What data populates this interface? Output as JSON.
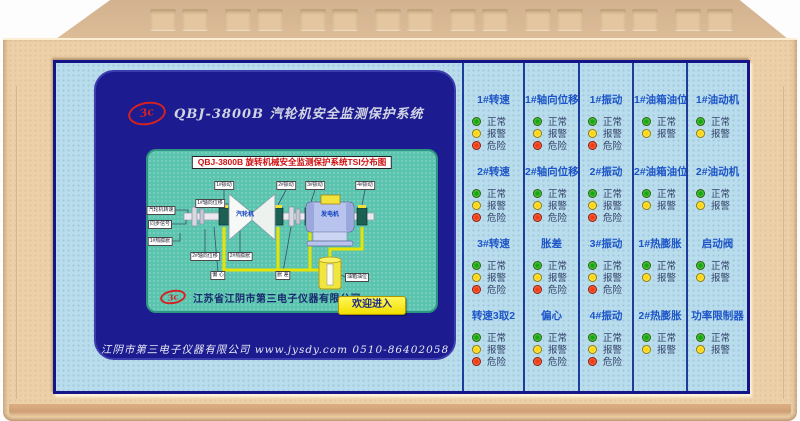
{
  "screen": {
    "logo_text": "3c",
    "header_title": "QBJ-3800B 汽轮机安全监测保护系统",
    "mimic": {
      "banner": "QBJ-3800B 旋转机械安全监测保护系统TSI分布图",
      "machine_labels": {
        "turbine": "汽轮机",
        "generator": "发电机"
      },
      "sensor_tags": {
        "top": [
          "1#振动",
          "2#振动",
          "3#振动",
          "4#振动"
        ],
        "left": [
          "1#轴向位移",
          "汽轮机转速",
          "同步信号",
          "1#热膨胀"
        ],
        "bottom": [
          "2#轴向位移",
          "2#热膨胀",
          "偏 心",
          "胀 差",
          "油箱油位"
        ]
      },
      "company": "江苏省江阴市第三电子仪器有限公司",
      "enter_button": "欢迎进入"
    },
    "footer": "江阴市第三电子仪器有限公司  www.jysdy.com  0510-86402058"
  },
  "panel": {
    "led_labels": {
      "normal": "正常",
      "alarm": "报警",
      "danger": "危险"
    },
    "columns": [
      {
        "cells": [
          {
            "title": "1#转速",
            "leds": [
              "normal",
              "alarm",
              "danger"
            ]
          },
          {
            "title": "2#转速",
            "leds": [
              "normal",
              "alarm",
              "danger"
            ]
          },
          {
            "title": "3#转速",
            "leds": [
              "normal",
              "alarm",
              "danger"
            ]
          },
          {
            "title": "转速3取2",
            "leds": [
              "normal",
              "alarm",
              "danger"
            ]
          }
        ]
      },
      {
        "cells": [
          {
            "title": "1#轴向位移",
            "leds": [
              "normal",
              "alarm",
              "danger"
            ]
          },
          {
            "title": "2#轴向位移",
            "leds": [
              "normal",
              "alarm",
              "danger"
            ]
          },
          {
            "title": "胀差",
            "leds": [
              "normal",
              "alarm",
              "danger"
            ]
          },
          {
            "title": "偏心",
            "leds": [
              "normal",
              "alarm",
              "danger"
            ]
          }
        ]
      },
      {
        "cells": [
          {
            "title": "1#振动",
            "leds": [
              "normal",
              "alarm",
              "danger"
            ]
          },
          {
            "title": "2#振动",
            "leds": [
              "normal",
              "alarm",
              "danger"
            ]
          },
          {
            "title": "3#振动",
            "leds": [
              "normal",
              "alarm",
              "danger"
            ]
          },
          {
            "title": "4#振动",
            "leds": [
              "normal",
              "alarm",
              "danger"
            ]
          }
        ]
      },
      {
        "cells": [
          {
            "title": "1#油箱油位",
            "leds": [
              "normal",
              "alarm"
            ]
          },
          {
            "title": "2#油箱油位",
            "leds": [
              "normal",
              "alarm"
            ]
          },
          {
            "title": "1#热膨胀",
            "leds": [
              "normal",
              "alarm"
            ]
          },
          {
            "title": "2#热膨胀",
            "leds": [
              "normal",
              "alarm"
            ]
          }
        ]
      },
      {
        "cells": [
          {
            "title": "1#油动机",
            "leds": [
              "normal",
              "alarm"
            ]
          },
          {
            "title": "2#油动机",
            "leds": [
              "normal",
              "alarm"
            ]
          },
          {
            "title": "启动阀",
            "leds": [
              "normal",
              "alarm"
            ]
          },
          {
            "title": "功率限制器",
            "leds": [
              "normal",
              "alarm"
            ]
          }
        ]
      }
    ]
  },
  "colors": {
    "chassis_beige": "#ecd0a8",
    "panel_blue": "#b9ddec",
    "screen_navy": "#1c1b8f",
    "mimic_teal": "#5ac4ae",
    "divider_navy": "#1c3e9a",
    "title_blue": "#1d55c8",
    "banner_red": "#d01010",
    "button_yellow": "#f2df00",
    "led_normal": "#16a316",
    "led_alarm": "#ffd60a",
    "led_danger": "#ef3a12",
    "pipe_yellow": "#e8e400"
  }
}
